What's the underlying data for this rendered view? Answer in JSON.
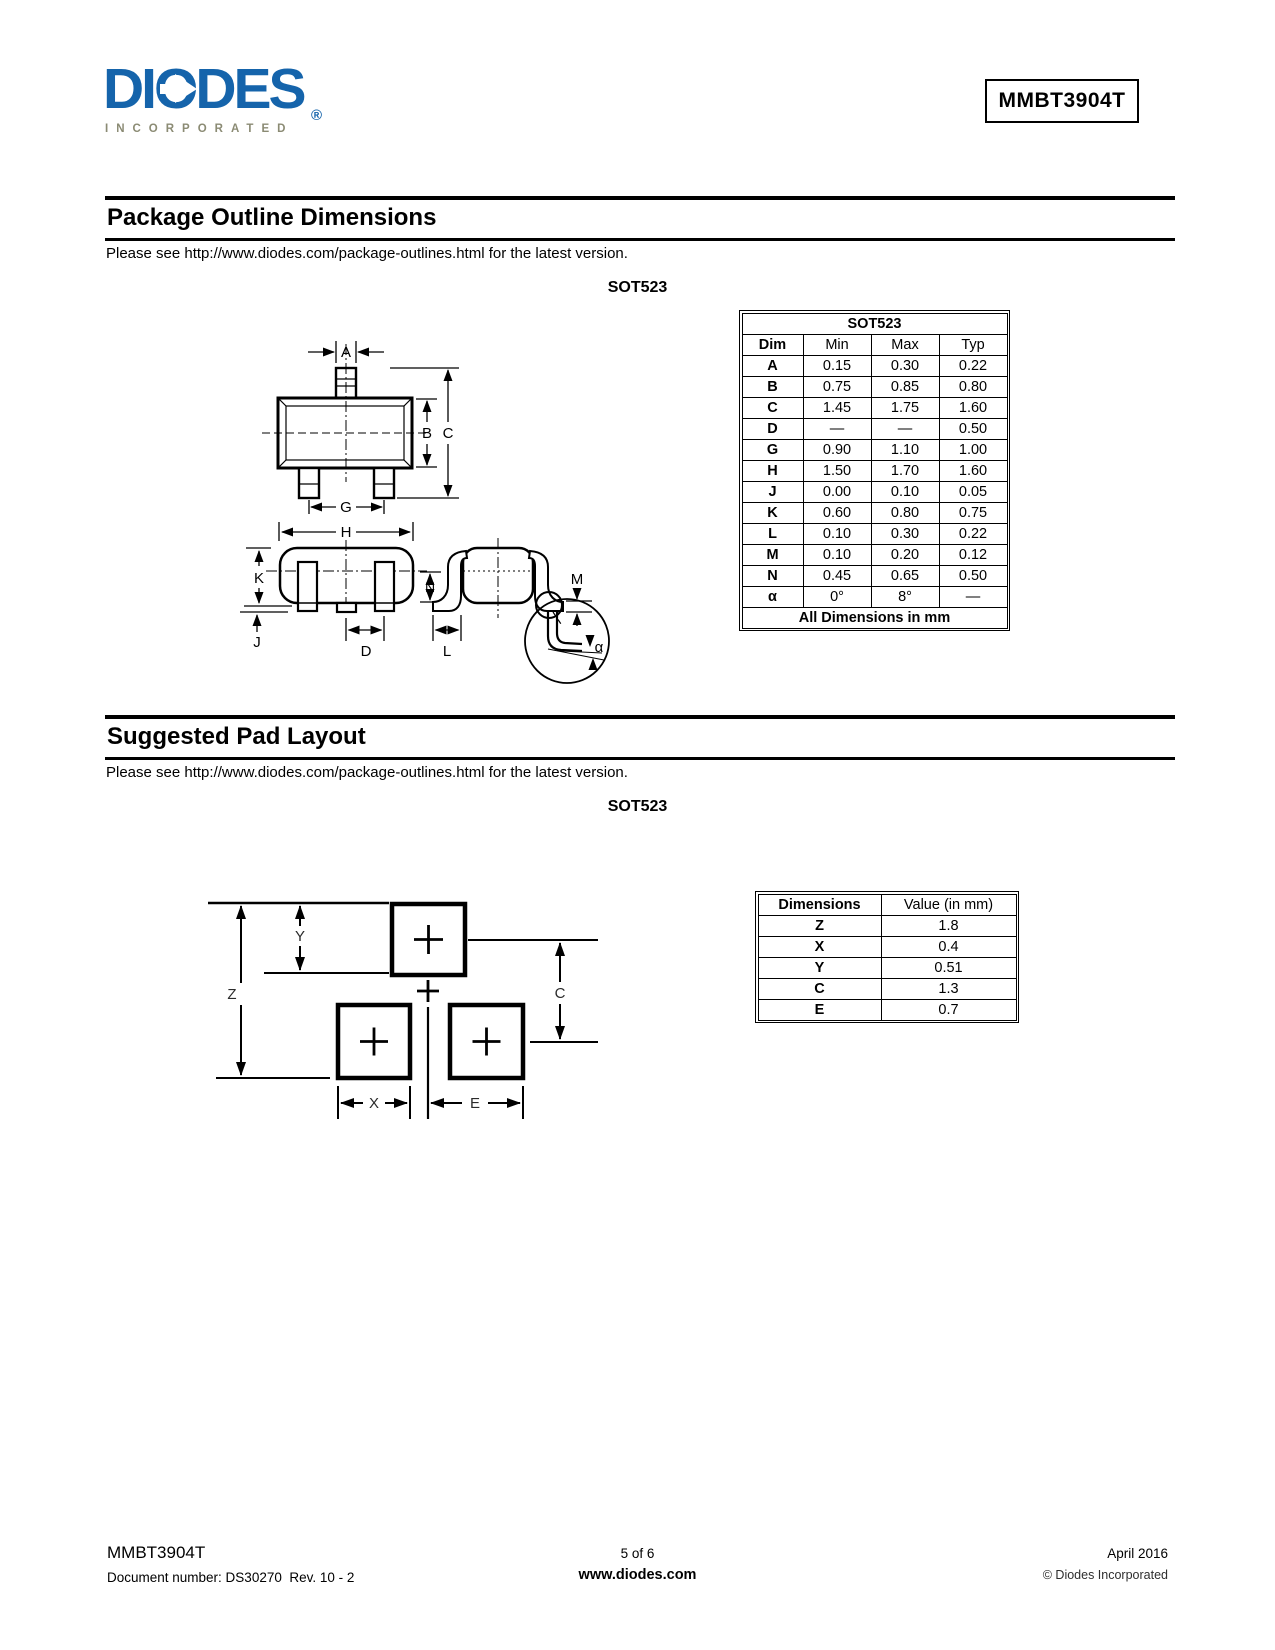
{
  "logo": {
    "brand": "DIODES",
    "sub": "INCORPORATED",
    "reg": "®"
  },
  "header": {
    "part_number": "MMBT3904T"
  },
  "sections": {
    "outline": {
      "title": "Package Outline Dimensions",
      "note": "Please see http://www.diodes.com/package-outlines.html for the latest version.",
      "package_label": "SOT523"
    },
    "pad": {
      "title": "Suggested Pad Layout",
      "note": "Please see http://www.diodes.com/package-outlines.html for the latest version.",
      "package_label": "SOT523"
    }
  },
  "outline_drawing": {
    "labels": {
      "a": "A",
      "b": "B",
      "c": "C",
      "g": "G",
      "h": "H",
      "k": "K",
      "j": "J",
      "d": "D",
      "n": "N",
      "l": "L",
      "m": "M",
      "alpha": "α"
    }
  },
  "pad_drawing": {
    "labels": {
      "z": "Z",
      "y": "Y",
      "c": "C",
      "x": "X",
      "e": "E"
    }
  },
  "outline_table": {
    "title": "SOT523",
    "headers": [
      "Dim",
      "Min",
      "Max",
      "Typ"
    ],
    "rows": [
      {
        "dim": "A",
        "min": "0.15",
        "max": "0.30",
        "typ": "0.22"
      },
      {
        "dim": "B",
        "min": "0.75",
        "max": "0.85",
        "typ": "0.80"
      },
      {
        "dim": "C",
        "min": "1.45",
        "max": "1.75",
        "typ": "1.60"
      },
      {
        "dim": "D",
        "min": "—",
        "max": "—",
        "typ": "0.50"
      },
      {
        "dim": "G",
        "min": "0.90",
        "max": "1.10",
        "typ": "1.00"
      },
      {
        "dim": "H",
        "min": "1.50",
        "max": "1.70",
        "typ": "1.60"
      },
      {
        "dim": "J",
        "min": "0.00",
        "max": "0.10",
        "typ": "0.05"
      },
      {
        "dim": "K",
        "min": "0.60",
        "max": "0.80",
        "typ": "0.75"
      },
      {
        "dim": "L",
        "min": "0.10",
        "max": "0.30",
        "typ": "0.22"
      },
      {
        "dim": "M",
        "min": "0.10",
        "max": "0.20",
        "typ": "0.12"
      },
      {
        "dim": "N",
        "min": "0.45",
        "max": "0.65",
        "typ": "0.50"
      },
      {
        "dim": "α",
        "min": "0°",
        "max": "8°",
        "typ": "—"
      }
    ],
    "footer": "All Dimensions in mm"
  },
  "pad_table": {
    "headers": [
      "Dimensions",
      "Value (in mm)"
    ],
    "rows": [
      {
        "dim": "Z",
        "value": "1.8"
      },
      {
        "dim": "X",
        "value": "0.4"
      },
      {
        "dim": "Y",
        "value": "0.51"
      },
      {
        "dim": "C",
        "value": "1.3"
      },
      {
        "dim": "E",
        "value": "0.7"
      }
    ]
  },
  "footer": {
    "part_number": "MMBT3904T",
    "doc_number": "Document number: DS30270  Rev. 10 - 2",
    "page_info": "5 of 6",
    "website": "www.diodes.com",
    "date": "April 2016",
    "copyright": "© Diodes Incorporated"
  }
}
